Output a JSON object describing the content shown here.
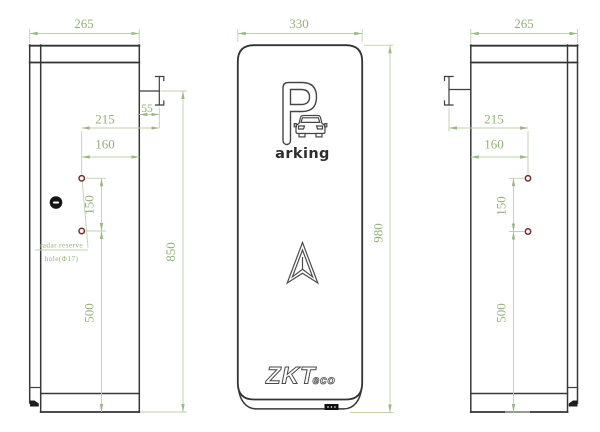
{
  "views": {
    "left": {
      "dims": {
        "width": "265",
        "bracket": "55",
        "hole_to_bracket": "215",
        "hole_to_edge": "160",
        "hole_gap": "150",
        "arm_height": "850",
        "hole_height": "500"
      },
      "note_line1": "radar reserve",
      "note_line2": "hole(Φ17)"
    },
    "front": {
      "dims": {
        "width": "330",
        "height": "980"
      },
      "logo_letter": "P",
      "logo_word": "arking",
      "brand_main": "ZKT",
      "brand_sub": "eco"
    },
    "right": {
      "dims": {
        "width": "265",
        "hole_to_bracket": "215",
        "hole_to_edge": "160",
        "hole_gap": "150",
        "hole_height": "500"
      }
    }
  },
  "colors": {
    "outline": "#383838",
    "dimension_line": "#bdd1ab",
    "dimension_text": "#94b079",
    "hole_ring": "#6f2e31"
  }
}
